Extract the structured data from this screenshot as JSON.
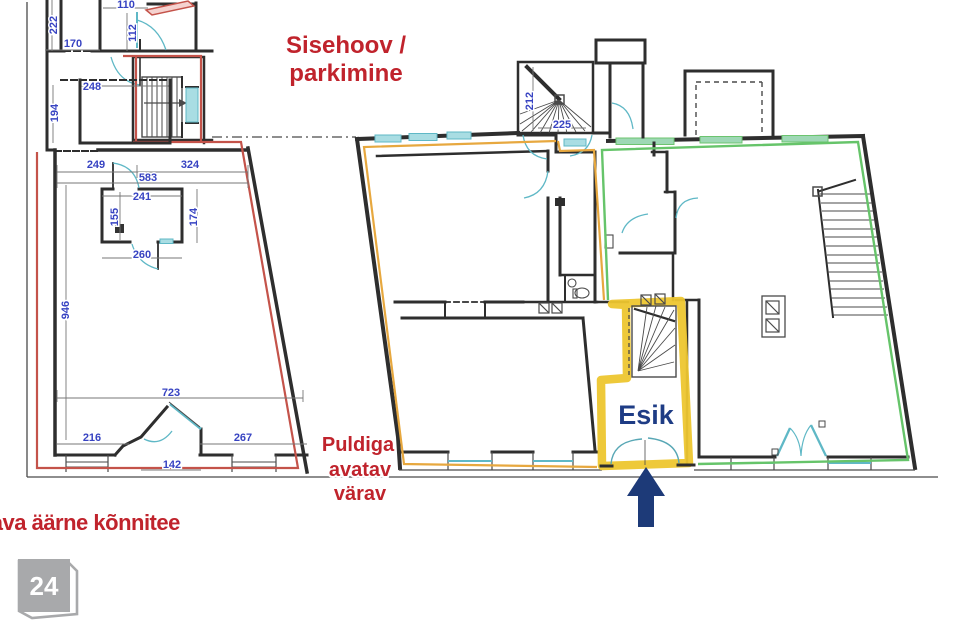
{
  "annotations": {
    "courtyard_label": {
      "line1": "Sisehoov /",
      "line2": "parkimine"
    },
    "gate_label": {
      "line1": "Puldiga",
      "line2": "avatav",
      "line3": "värav"
    },
    "sidewalk_label": "Tallinna tänava äärne kõnnitee",
    "entry_room_label": "Esik",
    "page_badge": "24"
  },
  "dimensions_cm": {
    "d222": "222",
    "d170": "170",
    "d110": "110",
    "d112": "112",
    "d248": "248",
    "d194": "194",
    "d249": "249",
    "d324": "324",
    "d583": "583",
    "d241": "241",
    "d155": "155",
    "d174": "174",
    "d260": "260",
    "d946": "946",
    "d723": "723",
    "d216": "216",
    "d267": "267",
    "d142": "142",
    "d212": "212",
    "d225": "225"
  },
  "colors": {
    "annotation_red": "#c0232c",
    "dimension_blue": "#3743c2",
    "plan_line": "#2e2e2e",
    "outline_red": "#c4534a",
    "outline_orange": "#e7a83f",
    "outline_green": "#66c46a",
    "highlight_yellow": "#edc62f",
    "arrow_navy": "#1d3a78",
    "door_teal": "#5fb8c6",
    "badge_gray": "#a8a9ab"
  },
  "icons": {
    "entrance_arrow": "up-arrow",
    "page_badge_shape": "folded-corner-sticker"
  }
}
